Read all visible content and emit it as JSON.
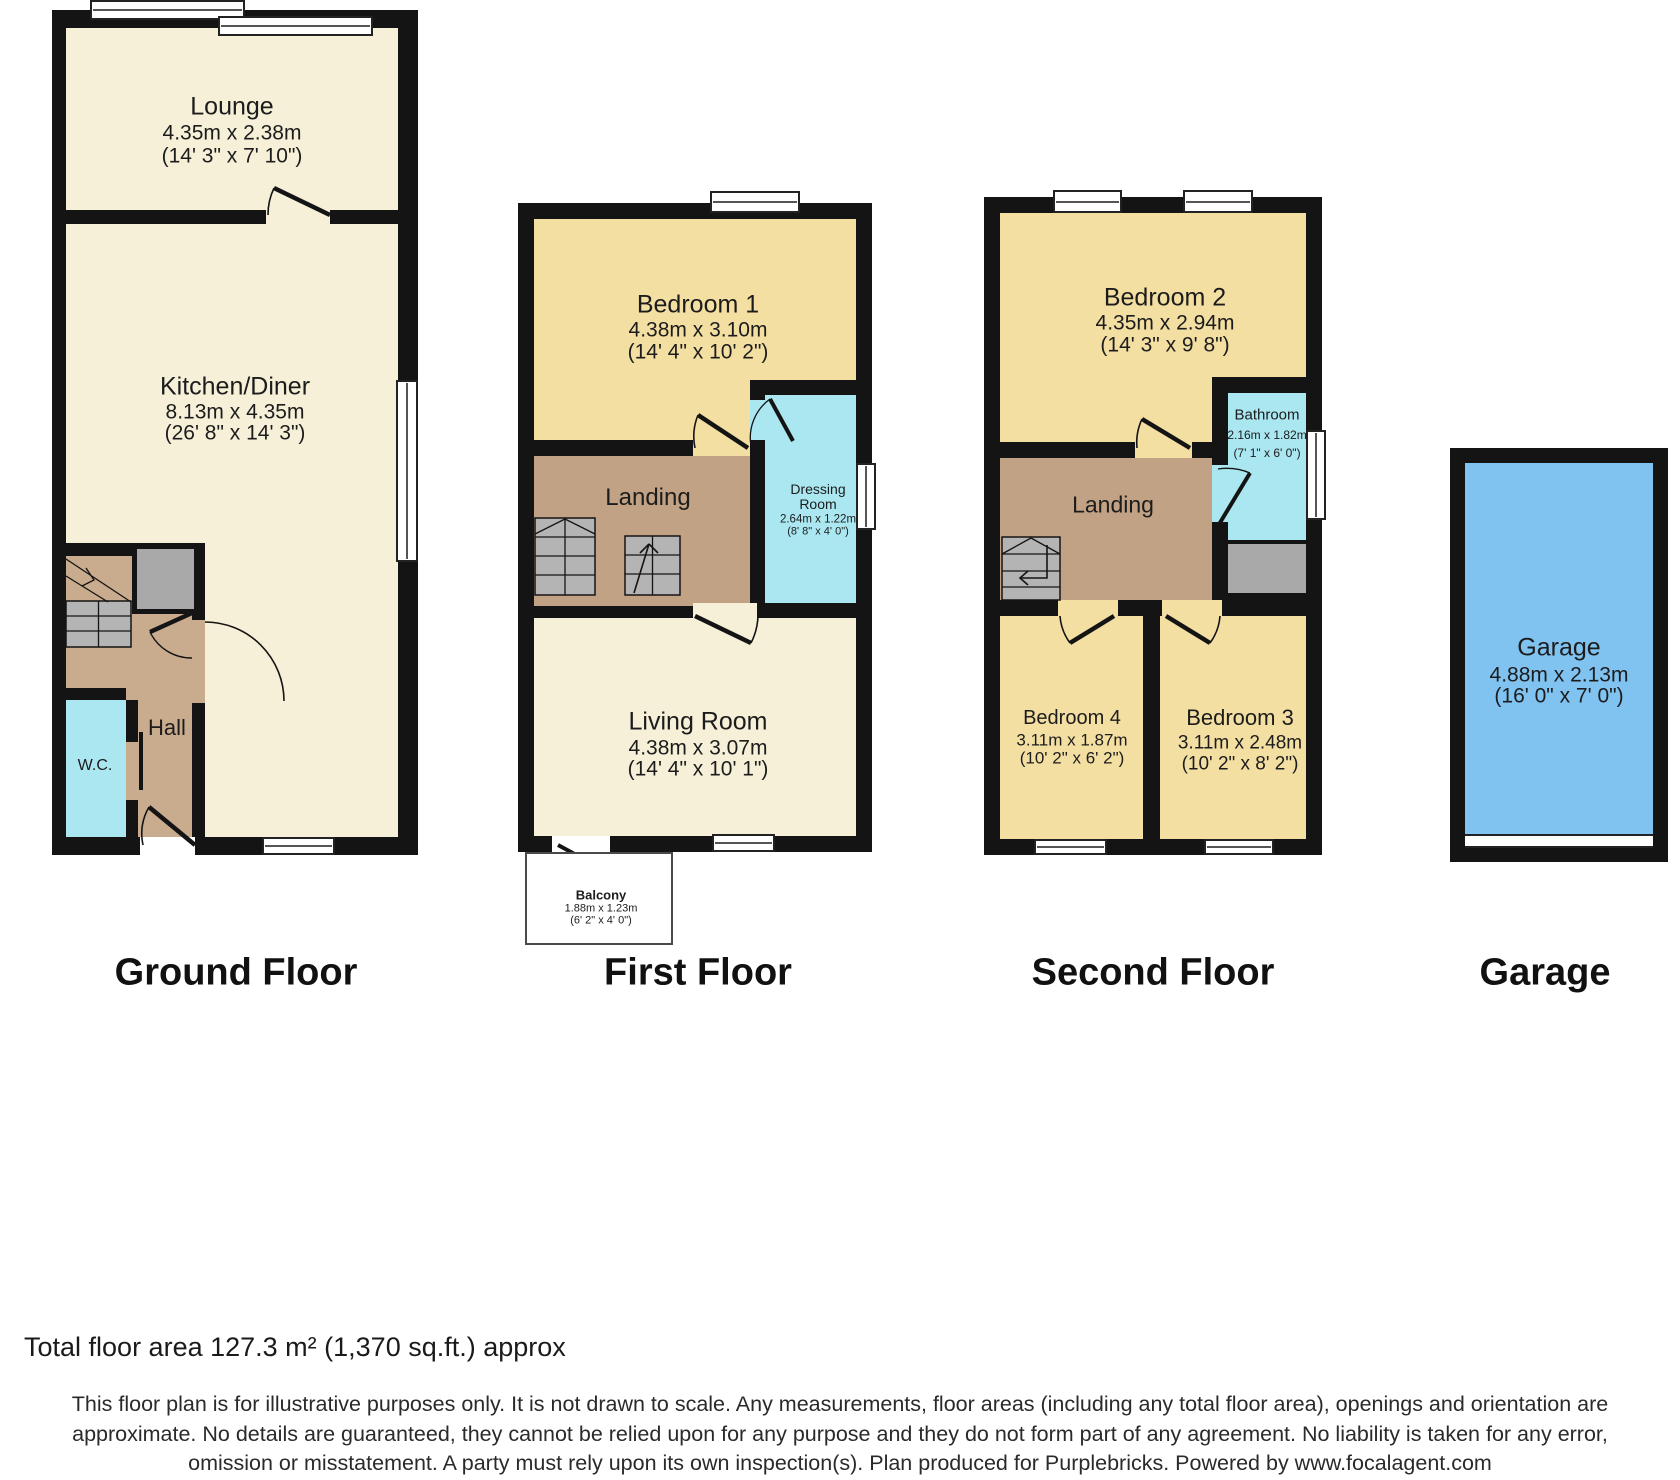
{
  "floors": {
    "ground": {
      "label": "Ground Floor",
      "lounge": {
        "name": "Lounge",
        "m": "4.35m x 2.38m",
        "ft": "(14' 3\" x 7' 10\")"
      },
      "kitchen": {
        "name": "Kitchen/Diner",
        "m": "8.13m x 4.35m",
        "ft": "(26' 8\" x 14' 3\")"
      },
      "hall": {
        "name": "Hall"
      },
      "wc": {
        "name": "W.C."
      }
    },
    "first": {
      "label": "First Floor",
      "bedroom1": {
        "name": "Bedroom 1",
        "m": "4.38m x 3.10m",
        "ft": "(14' 4\" x 10' 2\")"
      },
      "landing": {
        "name": "Landing"
      },
      "dressing": {
        "name_line1": "Dressing",
        "name_line2": "Room",
        "m": "2.64m x 1.22m",
        "ft": "(8' 8\" x 4' 0\")"
      },
      "living": {
        "name": "Living Room",
        "m": "4.38m x 3.07m",
        "ft": "(14' 4\" x 10' 1\")"
      },
      "balcony": {
        "name": "Balcony",
        "m": "1.88m x 1.23m",
        "ft": "(6' 2\" x 4' 0\")"
      }
    },
    "second": {
      "label": "Second Floor",
      "bedroom2": {
        "name": "Bedroom 2",
        "m": "4.35m x 2.94m",
        "ft": "(14' 3\" x 9' 8\")"
      },
      "bathroom": {
        "name": "Bathroom",
        "m": "2.16m x 1.82m",
        "ft": "(7' 1\" x 6' 0\")"
      },
      "landing": {
        "name": "Landing"
      },
      "bedroom4": {
        "name": "Bedroom 4",
        "m": "3.11m x 1.87m",
        "ft": "(10' 2\" x 6' 2\")"
      },
      "bedroom3": {
        "name": "Bedroom 3",
        "m": "3.11m x 2.48m",
        "ft": "(10' 2\" x 8' 2\")"
      }
    },
    "garage": {
      "label": "Garage",
      "garage": {
        "name": "Garage",
        "m": "4.88m x 2.13m",
        "ft": "(16' 0\" x 7' 0\")"
      }
    }
  },
  "footer": {
    "total_area": "Total floor area 127.3 m² (1,370 sq.ft.) approx",
    "disclaimer": [
      "This floor plan is for illustrative purposes only. It is not drawn to scale. Any measurements, floor areas (including any total floor area), openings and orientation are",
      "approximate. No details are guaranteed, they cannot be relied upon for any purpose and they do not form part of any agreement. No liability is taken for any error,",
      "omission or misstatement. A party must rely upon its own inspection(s). Plan produced for Purplebricks. Powered by www.focalagent.com"
    ]
  },
  "colors": {
    "wall": "#141414",
    "living_cream": "#f6f0d8",
    "bedroom_yellow": "#f4dfa3",
    "hall_tan": "#c9ab8e",
    "landing_tan": "#c2a285",
    "wet_room_cyan": "#aae7f1",
    "garage_blue": "#80c3f0",
    "stair_gray": "#b4b4b4",
    "closet_gray": "#a9a9a9"
  }
}
